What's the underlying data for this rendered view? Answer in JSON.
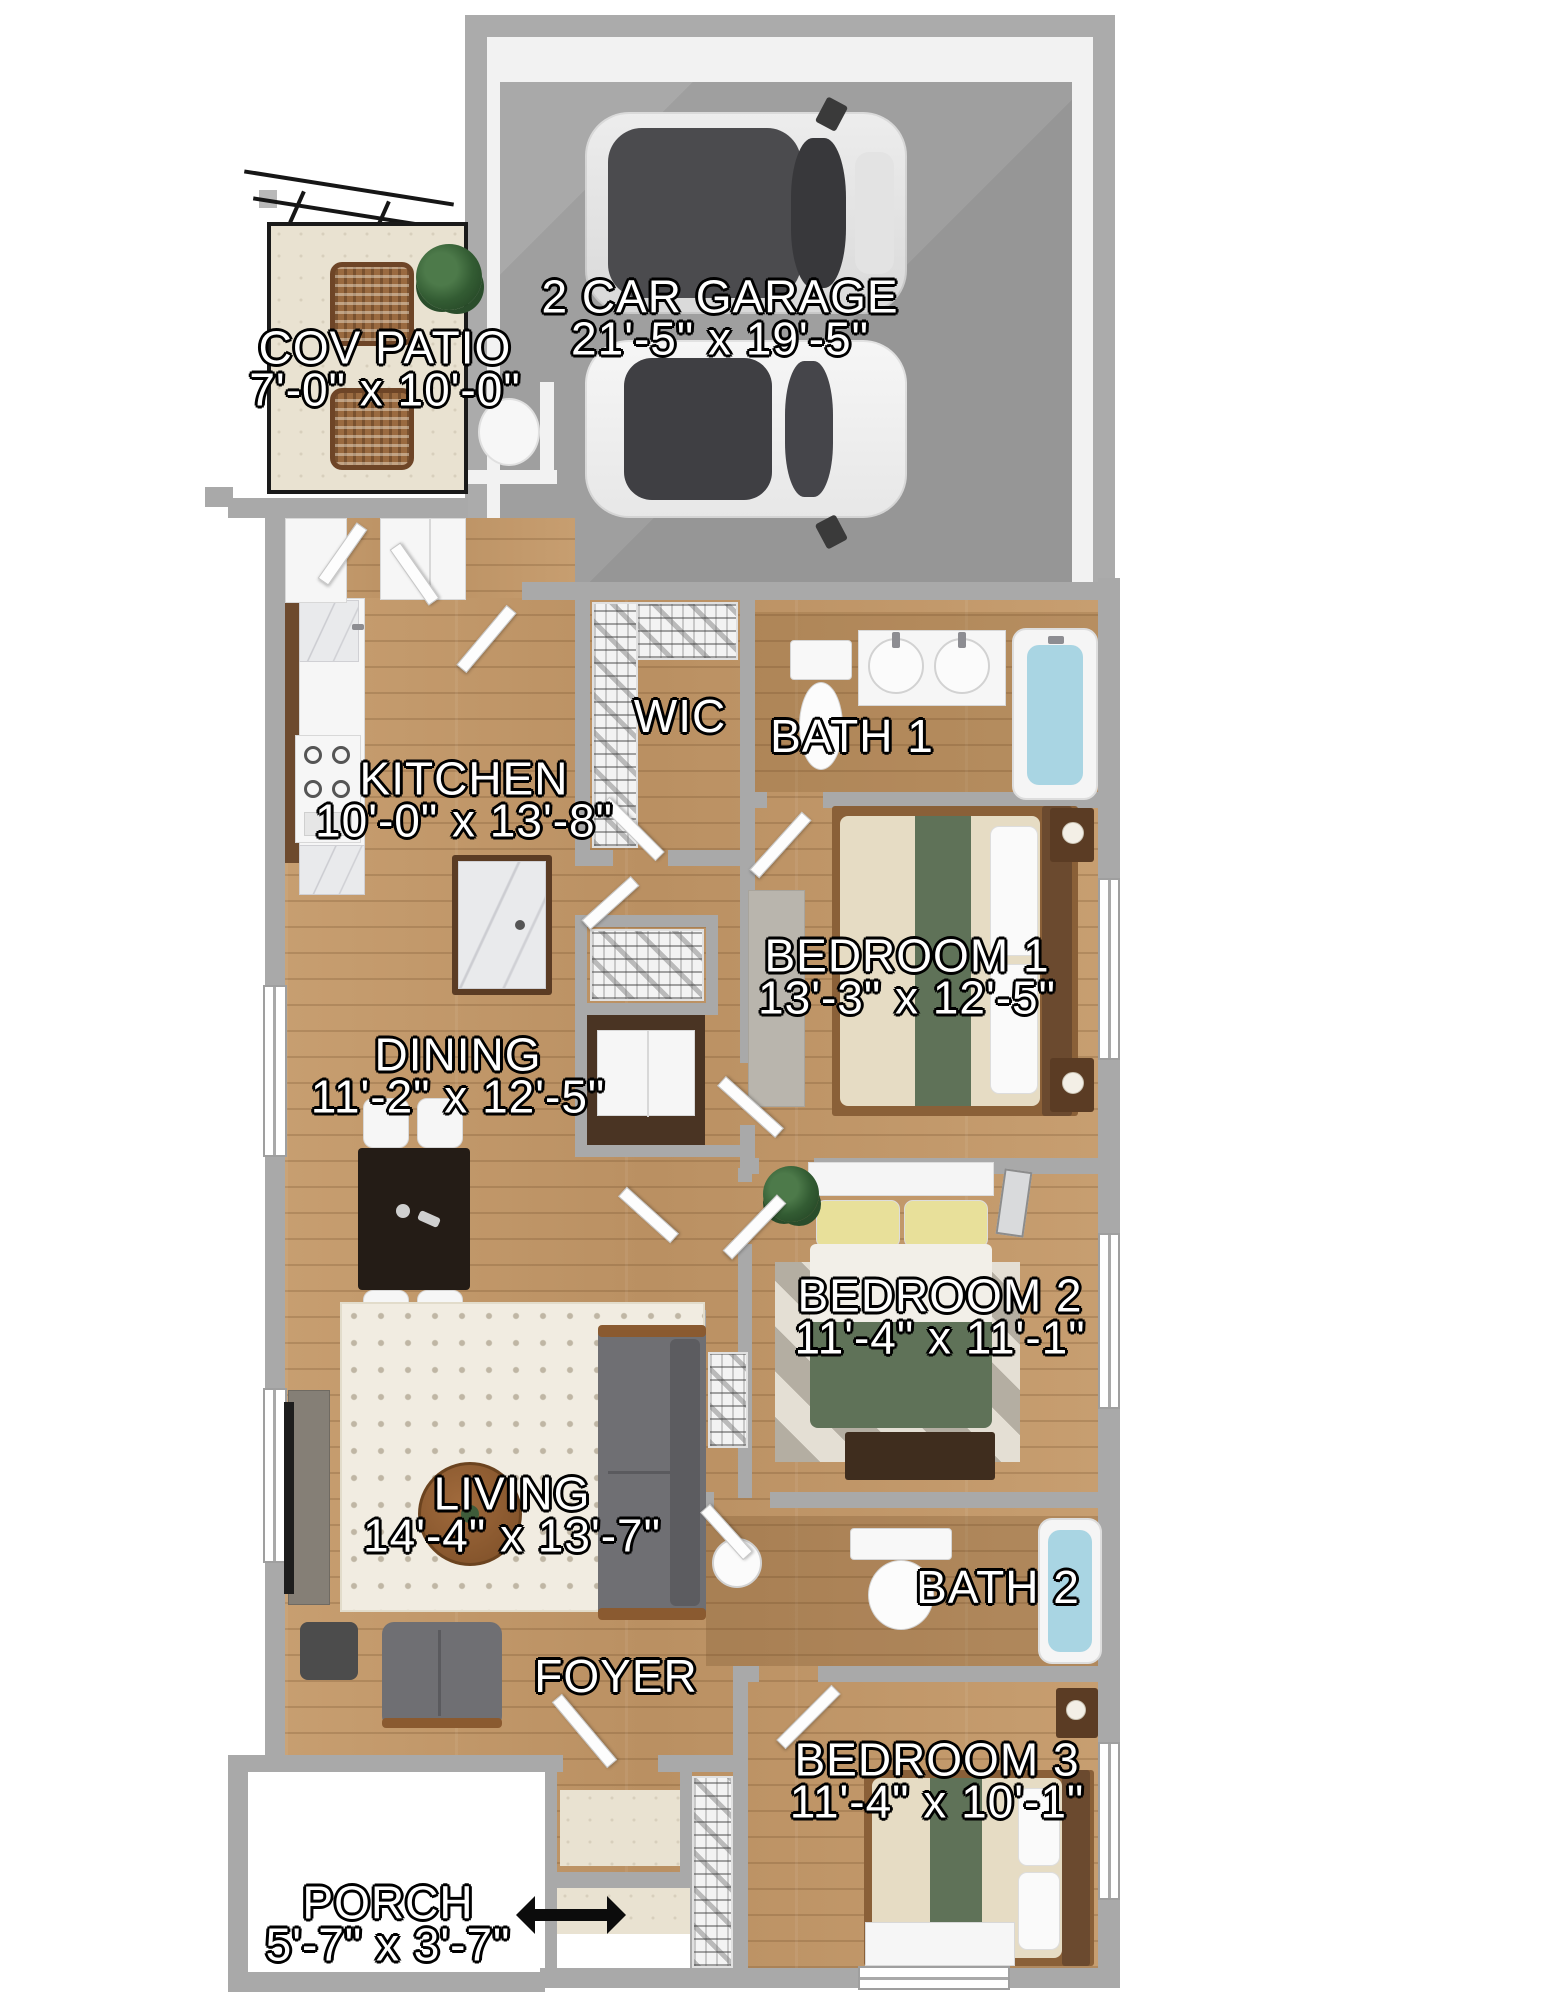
{
  "plan": {
    "rooms": [
      {
        "key": "garage",
        "name": "2 CAR GARAGE",
        "dims": "21'-5\" x 19'-5\""
      },
      {
        "key": "cov_patio",
        "name": "COV PATIO",
        "dims": "7'-0\" x 10'-0\""
      },
      {
        "key": "wic",
        "name": "WIC",
        "dims": ""
      },
      {
        "key": "bath1",
        "name": "BATH 1",
        "dims": ""
      },
      {
        "key": "kitchen",
        "name": "KITCHEN",
        "dims": "10'-0\" x 13'-8\""
      },
      {
        "key": "bedroom1",
        "name": "BEDROOM 1",
        "dims": "13'-3\" x 12'-5\""
      },
      {
        "key": "dining",
        "name": "DINING",
        "dims": "11'-2\" x 12'-5\""
      },
      {
        "key": "bedroom2",
        "name": "BEDROOM 2",
        "dims": "11'-4\" x 11'-1\""
      },
      {
        "key": "living",
        "name": "LIVING",
        "dims": "14'-4\" x 13'-7\""
      },
      {
        "key": "bath2",
        "name": "BATH 2",
        "dims": ""
      },
      {
        "key": "foyer",
        "name": "FOYER",
        "dims": ""
      },
      {
        "key": "bedroom3",
        "name": "BEDROOM 3",
        "dims": "11'-4\" x 10'-1\""
      },
      {
        "key": "porch",
        "name": "PORCH",
        "dims": "5'-7\" x 3'-7\""
      }
    ],
    "colors": {
      "wall": "#a9a9a9",
      "wood_floor": "#c59b6d",
      "concrete": "#9f9f9f",
      "tile": "#e9e2d1",
      "tub_water": "#a9d5e3",
      "bedding_accent_green": "#5f7258",
      "label_fill": "#ffffff",
      "label_outline": "#000000"
    }
  }
}
